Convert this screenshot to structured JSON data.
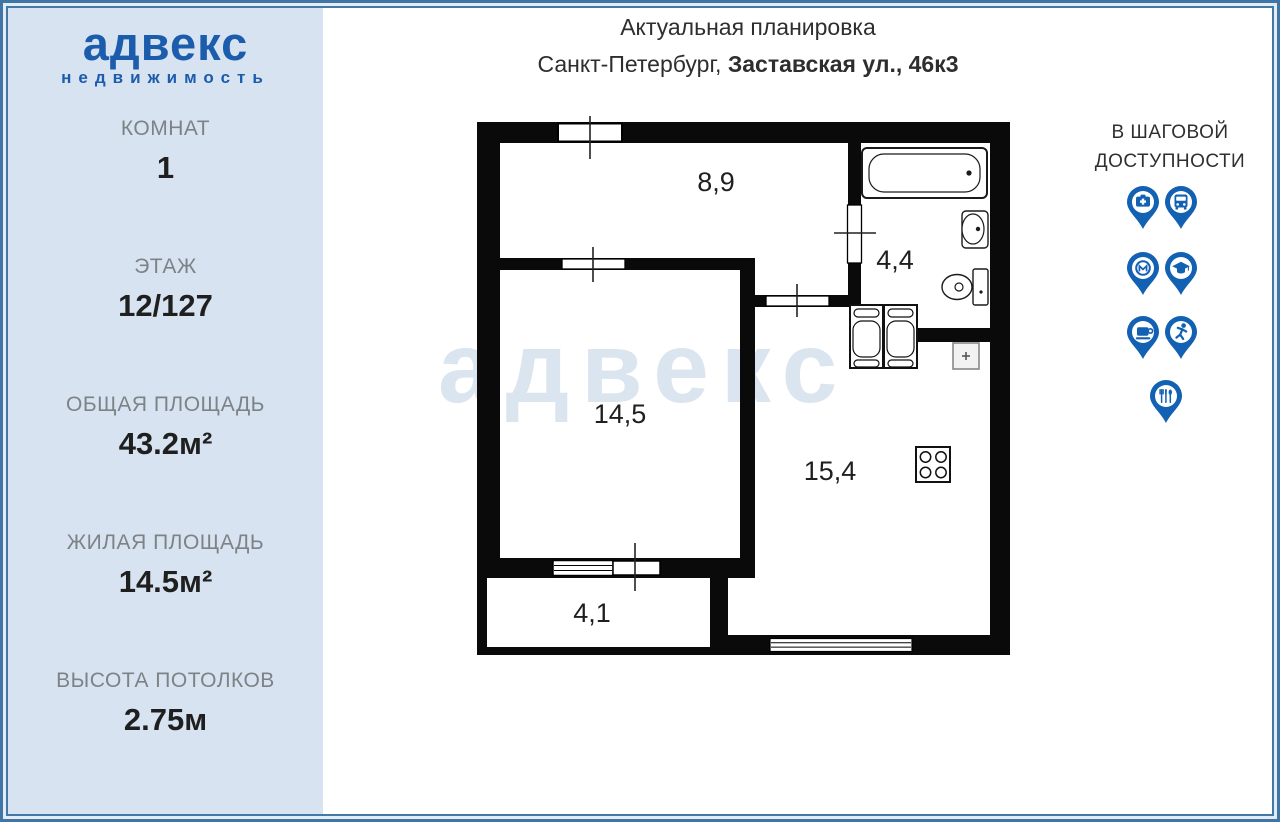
{
  "colors": {
    "accent_blue": "#1c5cac",
    "pin_blue": "#1261b2",
    "sidebar_bg": "#d7e3f0",
    "frame_blue": "#3f76a6",
    "label_gray": "#7d8286",
    "value_dark": "#1f1f1f",
    "wall_black": "#0a0a0a",
    "watermark_blue": "#dbe5f0"
  },
  "sidebar": {
    "logo": {
      "title": "адвекс",
      "subtitle": "недвижимость"
    },
    "specs": [
      {
        "label": "КОМНАТ",
        "value": "1"
      },
      {
        "label": "ЭТАЖ",
        "value": "12/127"
      },
      {
        "label": "ОБЩАЯ ПЛОЩАДЬ",
        "value": "43.2м²"
      },
      {
        "label": "ЖИЛАЯ ПЛОЩАДЬ",
        "value": "14.5м²"
      },
      {
        "label": "ВЫСОТА ПОТОЛКОВ",
        "value": "2.75м"
      }
    ]
  },
  "header": {
    "title": "Актуальная планировка",
    "city": "Санкт-Петербург, ",
    "address": "Заставская ул., 46к3"
  },
  "floorplan": {
    "watermark": "адвекс",
    "rooms": [
      {
        "name": "hallway",
        "area": "8,9"
      },
      {
        "name": "bathroom",
        "area": "4,4"
      },
      {
        "name": "living-room",
        "area": "14,5"
      },
      {
        "name": "kitchen",
        "area": "15,4"
      },
      {
        "name": "balcony",
        "area": "4,1"
      }
    ],
    "fixtures": [
      "bathtub",
      "wash-basin",
      "toilet",
      "washing-machines",
      "kitchen-sink",
      "stove"
    ]
  },
  "nearby": {
    "heading_line1": "В ШАГОВОЙ",
    "heading_line2": "ДОСТУПНОСТИ",
    "pins": [
      "pharmacy",
      "bus",
      "metro",
      "education",
      "cafe",
      "sports",
      "restaurant"
    ]
  }
}
